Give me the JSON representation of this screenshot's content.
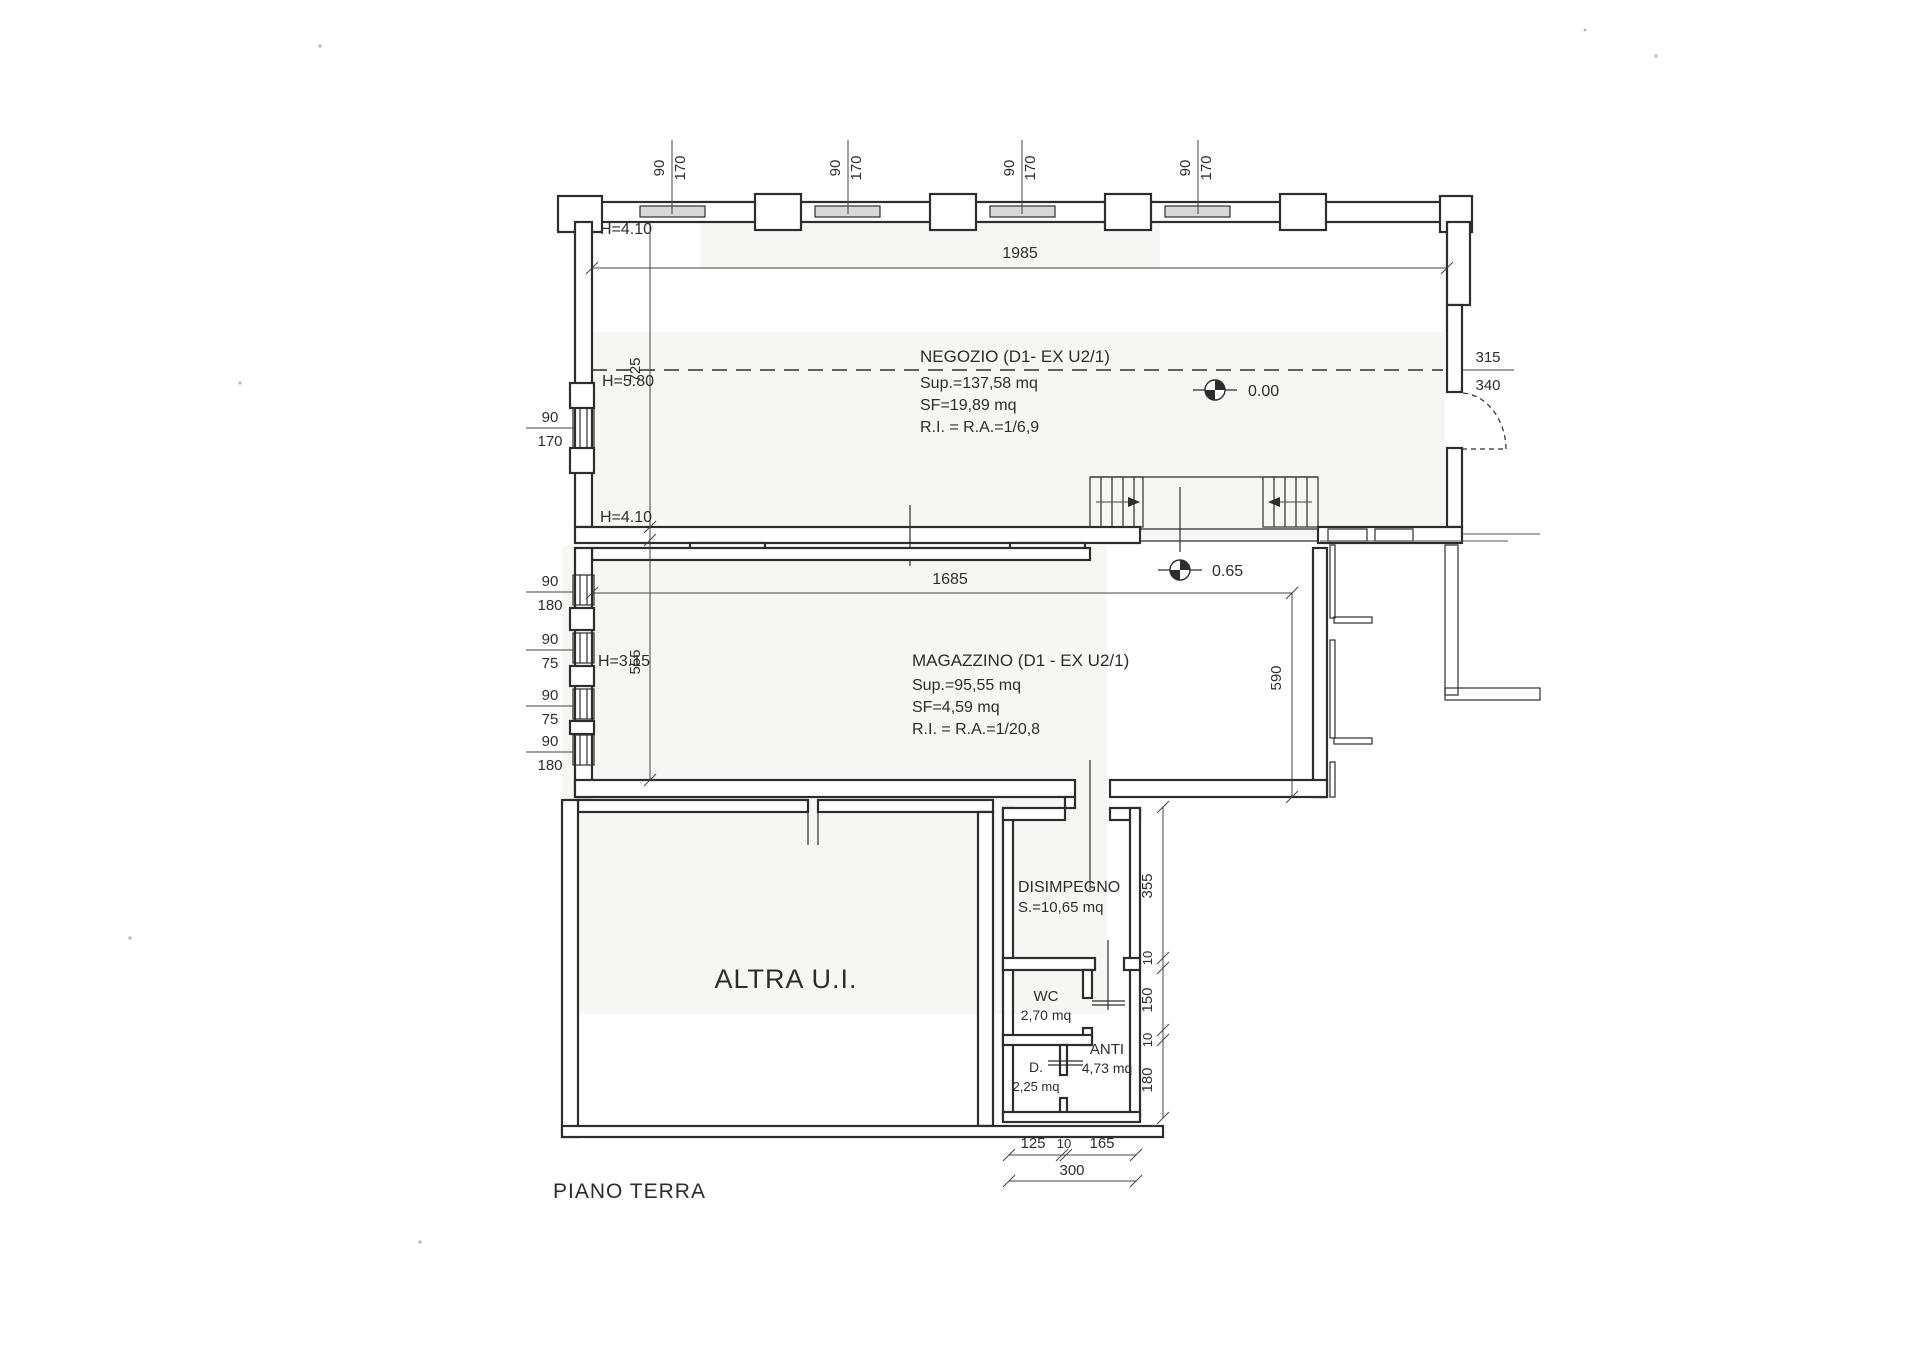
{
  "page": {
    "title": "PIANO TERRA"
  },
  "colors": {
    "paper": "#ffffff",
    "ink": "#2d2d2d",
    "glazing": "#d8d8d8"
  },
  "labels": {
    "floor": "PIANO TERRA"
  },
  "rooms": {
    "negozio": {
      "title": "NEGOZIO (D1- EX U2/1)",
      "sup": "Sup.=137,58 mq",
      "sf": "SF=19,89 mq",
      "ri": "R.I. = R.A.=1/6,9",
      "h_top": "H=4.10",
      "h_mid": "H=5.80",
      "h_bottom": "H=4.10"
    },
    "magazzino": {
      "title": "MAGAZZINO (D1 - EX U2/1)",
      "sup": "Sup.=95,55 mq",
      "sf": "SF=4,59 mq",
      "ri": "R.I. = R.A.=1/20,8",
      "h": "H=3.15"
    },
    "altra_ui": {
      "title": "ALTRA U.I."
    },
    "disimpegno": {
      "title": "DISIMPEGNO",
      "area": "S.=10,65 mq"
    },
    "wc": {
      "title": "WC",
      "area": "2,70 mq"
    },
    "anti": {
      "title": "ANTI",
      "area": "4,73 mq"
    },
    "d": {
      "title": "D.",
      "area": "2,25 mq"
    }
  },
  "levels": {
    "ground": "0.00",
    "magazzino": "0.65"
  },
  "dims": {
    "negozio_width": "1985",
    "magazzino_width": "1685",
    "negozio_depth": "725",
    "magazzino_depth": "555",
    "magazzino_right": "590",
    "door_top": "315",
    "door_bottom": "340",
    "window_w": "90",
    "window_top_h": "170",
    "right_chain": [
      "355",
      "10",
      "150",
      "10",
      "180"
    ],
    "bottom_chain": [
      "125",
      "10",
      "165"
    ],
    "bottom_total": "300",
    "left_neg": {
      "w": "90",
      "h": "170"
    },
    "left_mag": [
      {
        "w": "90",
        "h": "180"
      },
      {
        "w": "90",
        "h": "75"
      },
      {
        "w": "90",
        "h": "75"
      },
      {
        "w": "90",
        "h": "180"
      }
    ]
  }
}
